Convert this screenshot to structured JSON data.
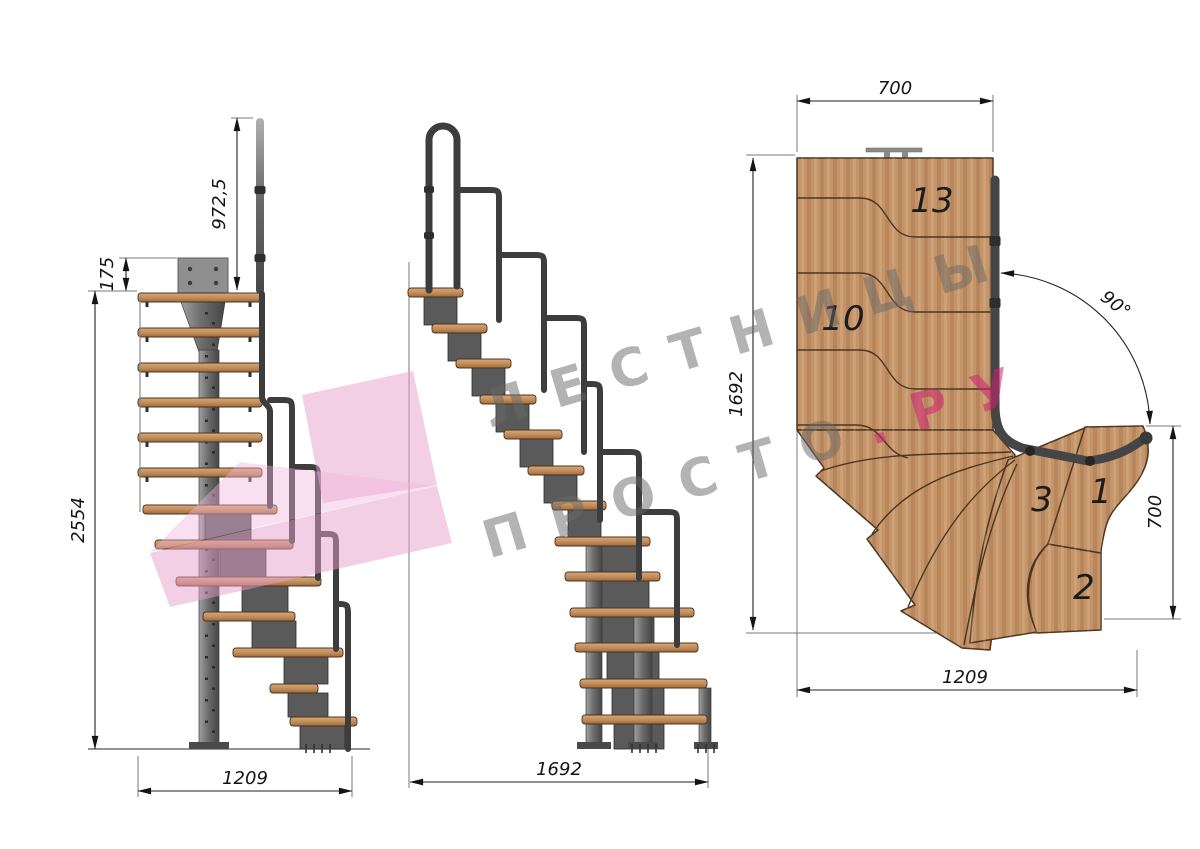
{
  "front_view": {
    "dim_rail_height": "972,5",
    "dim_plate_offset": "175",
    "dim_total_height": "2554",
    "dim_width": "1209"
  },
  "side_view": {
    "dim_length": "1692"
  },
  "plan_view": {
    "dim_top_width": "700",
    "dim_left_length": "1692",
    "dim_angle": "90°",
    "dim_right_depth": "700",
    "dim_bottom_width": "1209",
    "labels": {
      "step13": "13",
      "step10": "10",
      "step3": "3",
      "step1": "1",
      "step2": "2"
    }
  },
  "watermark": {
    "line1": "ЛЕСТНИЦЫ",
    "line2_gray": "ПРОСТО",
    "line2_accent": ".РУ"
  },
  "colors": {
    "wood": "#c59468",
    "wood_outline": "#4b3621",
    "metal": "#5a5a5a",
    "rail": "#3d3d3d",
    "dimension": "#1f1f1f",
    "logo_pink": "#e79fce",
    "watermark_gray": "#686868",
    "watermark_accent": "#cd2173"
  }
}
